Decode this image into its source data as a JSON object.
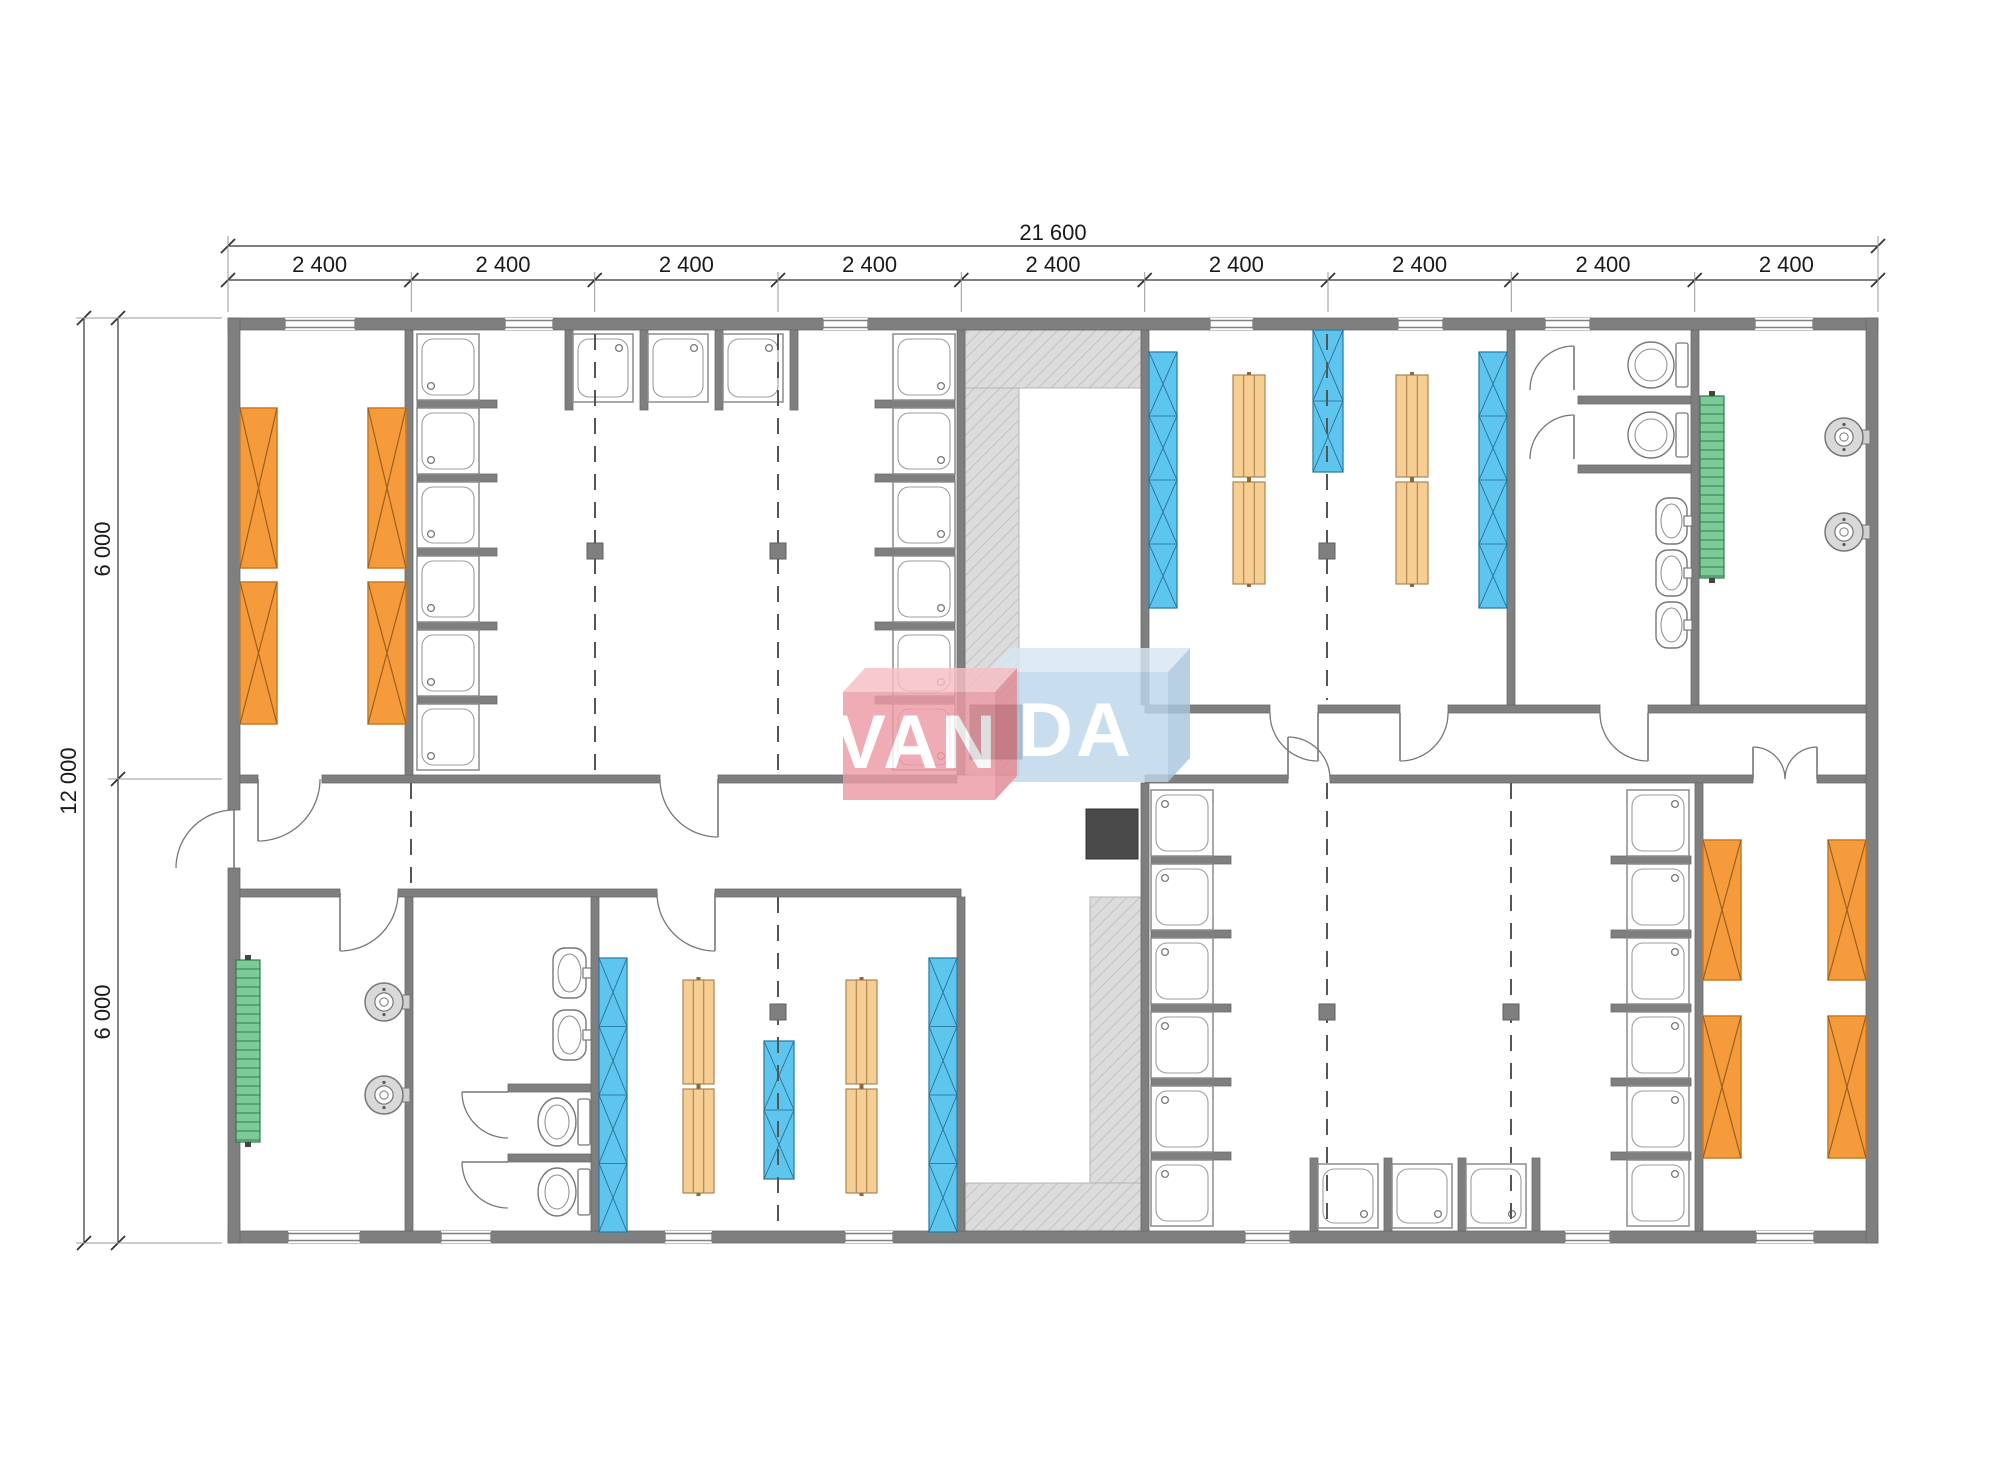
{
  "drawing": {
    "type": "modular-building-floor-plan",
    "brand": "VANDA"
  },
  "dimensions": {
    "top_total": {
      "label": "21 600",
      "x1": 228,
      "x2": 1878,
      "y": 246
    },
    "top_modules": {
      "y": 280,
      "bounds": [
        228,
        411.3,
        594.7,
        778,
        961.3,
        1144.7,
        1328,
        1511.3,
        1694.7,
        1878
      ],
      "labels": [
        "2 400",
        "2 400",
        "2 400",
        "2 400",
        "2 400",
        "2 400",
        "2 400",
        "2 400",
        "2 400"
      ]
    },
    "left_total": {
      "label": "12 000",
      "x": 84,
      "y1": 318,
      "y2": 1243
    },
    "left_halves": {
      "x": 118,
      "bounds": [
        318,
        779,
        1243
      ],
      "labels": [
        "6 000",
        "6 000"
      ]
    }
  },
  "logo": {
    "text_red": "VAN",
    "text_blue": "DA",
    "red_main": "#ec9ba5",
    "red_top": "#f6bfc5",
    "red_side": "#e08893",
    "blue_main": "#bcd6ea",
    "blue_top": "#d7e7f4",
    "blue_side": "#a9c6dd",
    "text_color": "#ffffff",
    "opacity": 0.82
  },
  "palette": {
    "wall": "#7f7f7f",
    "wall_edge": "#6a6a6a",
    "bed_fill": "#F59B3C",
    "bed_stroke": "#C87A24",
    "bed_x": "#9a6020",
    "locker_fill": "#5EC6EE",
    "locker_stroke": "#2E7FA6",
    "bench_fill": "#F6CE93",
    "bench_stroke": "#A98550",
    "rack_fill": "#7CCB96",
    "rack_stroke": "#2F7D4F",
    "hatch_bg": "#DCDCDC",
    "hatch_line": "#c2c2c2",
    "fixture_stroke": "#777777",
    "dark_equipment": "#4a4a4a",
    "dim_line": "#333333",
    "dim_text": "#1a1a1a",
    "ext_line": "#999999",
    "dash_line": "#555555",
    "column_fill": "#7f7f7f"
  },
  "plan": {
    "building": {
      "x": 228,
      "y": 318,
      "w": 1650,
      "h": 925
    },
    "walls": [
      [
        228,
        318,
        1650,
        12
      ],
      [
        228,
        1231,
        1650,
        12
      ],
      [
        228,
        318,
        12,
        492
      ],
      [
        228,
        868,
        12,
        375
      ],
      [
        1866,
        318,
        12,
        925
      ],
      [
        405,
        330,
        8,
        445
      ],
      [
        957,
        330,
        8,
        445
      ],
      [
        1141,
        330,
        8,
        375
      ],
      [
        1507,
        330,
        8,
        375
      ],
      [
        1691,
        330,
        8,
        375
      ],
      [
        1145,
        705,
        125,
        8
      ],
      [
        1318,
        705,
        82,
        8
      ],
      [
        1448,
        705,
        152,
        8
      ],
      [
        1648,
        705,
        218,
        8
      ],
      [
        240,
        775,
        18,
        8
      ],
      [
        322,
        775,
        338,
        8
      ],
      [
        718,
        775,
        239,
        8
      ],
      [
        1145,
        775,
        143,
        8
      ],
      [
        1330,
        775,
        423,
        8
      ],
      [
        1817,
        775,
        49,
        8
      ],
      [
        240,
        889,
        100,
        8
      ],
      [
        398,
        889,
        259,
        8
      ],
      [
        715,
        889,
        246,
        8
      ],
      [
        405,
        897,
        8,
        334
      ],
      [
        591,
        897,
        8,
        334
      ],
      [
        957,
        897,
        8,
        334
      ],
      [
        1141,
        783,
        8,
        448
      ],
      [
        1695,
        783,
        8,
        448
      ],
      [
        1578,
        396,
        113,
        8
      ],
      [
        1578,
        465,
        113,
        8
      ],
      [
        508,
        1084,
        83,
        8
      ],
      [
        508,
        1154,
        83,
        8
      ],
      [
        417,
        400,
        80,
        8
      ],
      [
        417,
        474,
        80,
        8
      ],
      [
        417,
        548,
        80,
        8
      ],
      [
        417,
        622,
        80,
        8
      ],
      [
        417,
        696,
        80,
        8
      ],
      [
        875,
        400,
        80,
        8
      ],
      [
        875,
        474,
        80,
        8
      ],
      [
        875,
        548,
        80,
        8
      ],
      [
        875,
        622,
        80,
        8
      ],
      [
        875,
        696,
        80,
        8
      ],
      [
        565,
        330,
        8,
        80
      ],
      [
        640,
        330,
        8,
        80
      ],
      [
        715,
        330,
        8,
        80
      ],
      [
        790,
        330,
        8,
        80
      ],
      [
        1151,
        856,
        80,
        8
      ],
      [
        1151,
        930,
        80,
        8
      ],
      [
        1151,
        1004,
        80,
        8
      ],
      [
        1151,
        1078,
        80,
        8
      ],
      [
        1151,
        1152,
        80,
        8
      ],
      [
        1611,
        856,
        80,
        8
      ],
      [
        1611,
        930,
        80,
        8
      ],
      [
        1611,
        1004,
        80,
        8
      ],
      [
        1611,
        1078,
        80,
        8
      ],
      [
        1611,
        1152,
        80,
        8
      ],
      [
        1310,
        1158,
        8,
        73
      ],
      [
        1384,
        1158,
        8,
        73
      ],
      [
        1458,
        1158,
        8,
        73
      ],
      [
        1532,
        1158,
        8,
        73
      ]
    ],
    "hatches": [
      [
        965,
        330,
        176,
        58
      ],
      [
        965,
        388,
        54,
        387
      ],
      [
        1090,
        897,
        51,
        286
      ],
      [
        965,
        1183,
        176,
        48
      ]
    ],
    "windows_top": [
      [
        285,
        70
      ],
      [
        505,
        48
      ],
      [
        823,
        45
      ],
      [
        1210,
        43
      ],
      [
        1398,
        45
      ],
      [
        1545,
        45
      ],
      [
        1755,
        58
      ]
    ],
    "windows_bottom": [
      [
        288,
        72
      ],
      [
        441,
        50
      ],
      [
        665,
        47
      ],
      [
        845,
        48
      ],
      [
        1245,
        45
      ],
      [
        1565,
        45
      ],
      [
        1756,
        58
      ]
    ],
    "doors": [
      {
        "cx": 258,
        "cy": 779,
        "r": 62,
        "a0": 90,
        "a1": 0
      },
      {
        "cx": 718,
        "cy": 779,
        "r": 58,
        "a0": 90,
        "a1": 180
      },
      {
        "cx": 234,
        "cy": 868,
        "r": 58,
        "a0": 270,
        "a1": 180
      },
      {
        "cx": 340,
        "cy": 893,
        "r": 58,
        "a0": 90,
        "a1": 0
      },
      {
        "cx": 715,
        "cy": 893,
        "r": 58,
        "a0": 90,
        "a1": 180
      },
      {
        "cx": 1318,
        "cy": 713,
        "r": 48,
        "a0": 90,
        "a1": 180
      },
      {
        "cx": 1400,
        "cy": 713,
        "r": 48,
        "a0": 90,
        "a1": 0
      },
      {
        "cx": 1648,
        "cy": 713,
        "r": 48,
        "a0": 90,
        "a1": 180
      },
      {
        "cx": 1288,
        "cy": 779,
        "r": 42,
        "a0": 270,
        "a1": 0
      },
      {
        "cx": 1753,
        "cy": 779,
        "r": 32,
        "a0": 270,
        "a1": 0
      },
      {
        "cx": 1817,
        "cy": 779,
        "r": 32,
        "a0": 270,
        "a1": 180
      },
      {
        "cx": 1574,
        "cy": 390,
        "r": 44,
        "a0": 270,
        "a1": 180
      },
      {
        "cx": 1574,
        "cy": 459,
        "r": 44,
        "a0": 270,
        "a1": 180
      },
      {
        "cx": 508,
        "cy": 1092,
        "r": 46,
        "a0": 180,
        "a1": 90
      },
      {
        "cx": 508,
        "cy": 1162,
        "r": 46,
        "a0": 180,
        "a1": 90
      }
    ],
    "dashed": [
      [
        595,
        334,
        770
      ],
      [
        778,
        334,
        770
      ],
      [
        1327,
        334,
        700
      ],
      [
        411,
        783,
        889
      ],
      [
        778,
        897,
        1227
      ],
      [
        1327,
        783,
        1227
      ],
      [
        1511,
        783,
        1227
      ]
    ],
    "columns": [
      [
        595,
        551
      ],
      [
        778,
        551
      ],
      [
        1327,
        551
      ],
      [
        778,
        1012
      ],
      [
        1327,
        1012
      ],
      [
        1511,
        1012
      ]
    ],
    "dark_squares": [
      [
        970,
        705,
        52,
        54
      ],
      [
        1086,
        809,
        52,
        50
      ]
    ],
    "beds": [
      [
        240,
        408,
        37,
        160
      ],
      [
        240,
        582,
        37,
        142
      ],
      [
        368,
        408,
        38,
        160
      ],
      [
        368,
        582,
        38,
        142
      ],
      [
        1703,
        840,
        38,
        140
      ],
      [
        1703,
        1016,
        38,
        142
      ],
      [
        1828,
        840,
        38,
        140
      ],
      [
        1828,
        1016,
        38,
        142
      ]
    ],
    "lockers": [
      {
        "x": 1149,
        "y": 352,
        "w": 28,
        "h": 256,
        "sec": 4
      },
      {
        "x": 1313,
        "y": 330,
        "w": 30,
        "h": 142,
        "sec": 2
      },
      {
        "x": 1479,
        "y": 352,
        "w": 28,
        "h": 256,
        "sec": 4
      },
      {
        "x": 599,
        "y": 958,
        "w": 28,
        "h": 274,
        "sec": 4
      },
      {
        "x": 764,
        "y": 1041,
        "w": 30,
        "h": 138,
        "sec": 2
      },
      {
        "x": 929,
        "y": 958,
        "w": 28,
        "h": 274,
        "sec": 4
      }
    ],
    "benches": [
      [
        1233,
        375,
        32,
        102
      ],
      [
        1233,
        482,
        32,
        102
      ],
      [
        1396,
        375,
        32,
        102
      ],
      [
        1396,
        482,
        32,
        102
      ],
      [
        683,
        980,
        31,
        104
      ],
      [
        683,
        1089,
        31,
        104
      ],
      [
        846,
        980,
        31,
        104
      ],
      [
        846,
        1089,
        31,
        104
      ]
    ],
    "racks": [
      [
        1700,
        396,
        24,
        182
      ],
      [
        236,
        960,
        24,
        182
      ]
    ],
    "heaters": [
      [
        1844,
        437,
        19
      ],
      [
        1844,
        532,
        19
      ],
      [
        384,
        1002,
        19
      ],
      [
        384,
        1095,
        19
      ]
    ],
    "sinks": [
      [
        1656,
        498,
        36,
        46
      ],
      [
        1656,
        550,
        36,
        46
      ],
      [
        1656,
        602,
        36,
        46
      ],
      [
        553,
        948,
        38,
        50
      ],
      [
        553,
        1010,
        38,
        50
      ]
    ],
    "toilets": [
      [
        1628,
        340,
        62,
        50
      ],
      [
        1628,
        410,
        62,
        50
      ],
      [
        538,
        1096,
        54,
        52
      ],
      [
        538,
        1166,
        54,
        52
      ]
    ],
    "showers": [
      [
        417,
        334,
        62,
        66,
        "bl"
      ],
      [
        417,
        408,
        62,
        66,
        "bl"
      ],
      [
        417,
        482,
        62,
        66,
        "bl"
      ],
      [
        417,
        556,
        62,
        66,
        "bl"
      ],
      [
        417,
        630,
        62,
        66,
        "bl"
      ],
      [
        417,
        704,
        62,
        66,
        "bl"
      ],
      [
        893,
        334,
        62,
        66,
        "br"
      ],
      [
        893,
        408,
        62,
        66,
        "br"
      ],
      [
        893,
        482,
        62,
        66,
        "br"
      ],
      [
        893,
        556,
        62,
        66,
        "br"
      ],
      [
        893,
        630,
        62,
        66,
        "br"
      ],
      [
        893,
        704,
        62,
        66,
        "br"
      ],
      [
        573,
        334,
        60,
        68,
        "tr"
      ],
      [
        648,
        334,
        60,
        68,
        "tr"
      ],
      [
        723,
        334,
        60,
        68,
        "tr"
      ],
      [
        1151,
        790,
        62,
        66,
        "tl"
      ],
      [
        1151,
        864,
        62,
        66,
        "tl"
      ],
      [
        1151,
        938,
        62,
        66,
        "tl"
      ],
      [
        1151,
        1012,
        62,
        66,
        "tl"
      ],
      [
        1151,
        1086,
        62,
        66,
        "tl"
      ],
      [
        1151,
        1160,
        62,
        66,
        "tl"
      ],
      [
        1627,
        790,
        62,
        66,
        "tr"
      ],
      [
        1627,
        864,
        62,
        66,
        "tr"
      ],
      [
        1627,
        938,
        62,
        66,
        "tr"
      ],
      [
        1627,
        1012,
        62,
        66,
        "tr"
      ],
      [
        1627,
        1086,
        62,
        66,
        "tr"
      ],
      [
        1627,
        1160,
        62,
        66,
        "tr"
      ],
      [
        1318,
        1164,
        60,
        64,
        "br"
      ],
      [
        1392,
        1164,
        60,
        64,
        "br"
      ],
      [
        1466,
        1164,
        60,
        64,
        "br"
      ]
    ],
    "logo_geo": {
      "blue_main": [
        [
          988,
          672
        ],
        [
          1168,
          672
        ],
        [
          1168,
          782
        ],
        [
          988,
          782
        ]
      ],
      "blue_top": [
        [
          988,
          672
        ],
        [
          1010,
          648
        ],
        [
          1190,
          648
        ],
        [
          1168,
          672
        ]
      ],
      "blue_side": [
        [
          1168,
          672
        ],
        [
          1190,
          648
        ],
        [
          1190,
          758
        ],
        [
          1168,
          782
        ]
      ],
      "red_main": [
        [
          843,
          692
        ],
        [
          995,
          692
        ],
        [
          995,
          800
        ],
        [
          843,
          800
        ]
      ],
      "red_top": [
        [
          843,
          692
        ],
        [
          865,
          668
        ],
        [
          1017,
          668
        ],
        [
          995,
          692
        ]
      ],
      "red_side": [
        [
          995,
          692
        ],
        [
          1017,
          668
        ],
        [
          1017,
          776
        ],
        [
          995,
          800
        ]
      ],
      "text_red_pos": [
        917,
        768
      ],
      "text_blue_pos": [
        1076,
        756
      ],
      "font_size": 76
    }
  }
}
